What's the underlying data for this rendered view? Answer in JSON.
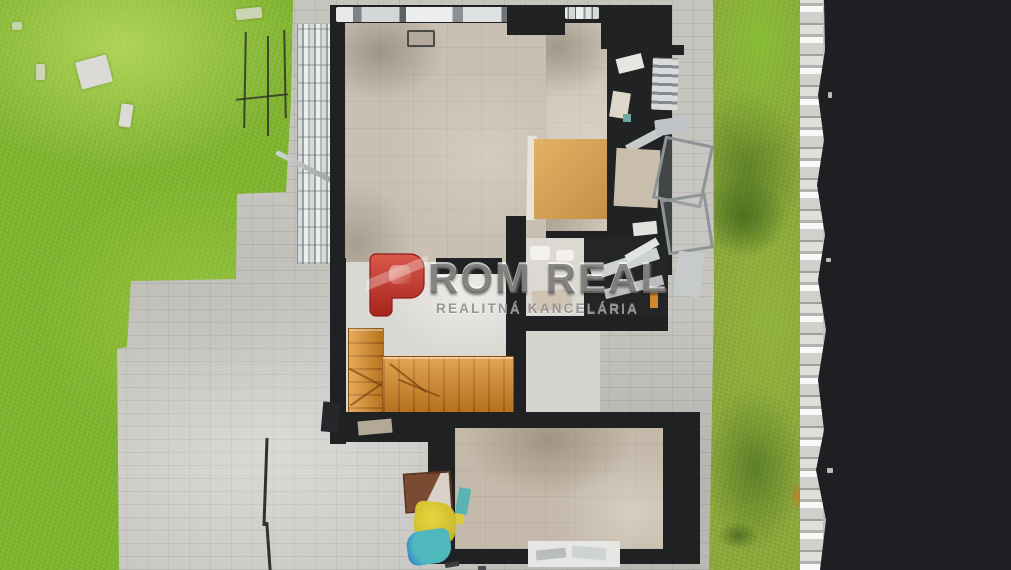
{
  "watermark": {
    "brand_initial": "P",
    "brand_text": "ROM REAL",
    "brand_full": "PROM REAL",
    "subtitle": "REALITNÁ KANCELÁRIA",
    "colors": {
      "red_top": "#d9584a",
      "red_bottom": "#a6231d",
      "text_gray": "#6c6a67"
    }
  },
  "scene": {
    "description": "Top-down aerial 3D-scan view of a house under construction with cut-away walls, wooden staircase, paved yard, lawns and unscanned black area on the right",
    "palette": {
      "grass_left": "#7fb42d",
      "grass_right": "#8ca838",
      "pavement": "#c6c4bf",
      "walls": "#1f2123",
      "floor": "#c9bfb2",
      "stairs_wood": "#cf8526",
      "void": "#1d1f22"
    }
  }
}
